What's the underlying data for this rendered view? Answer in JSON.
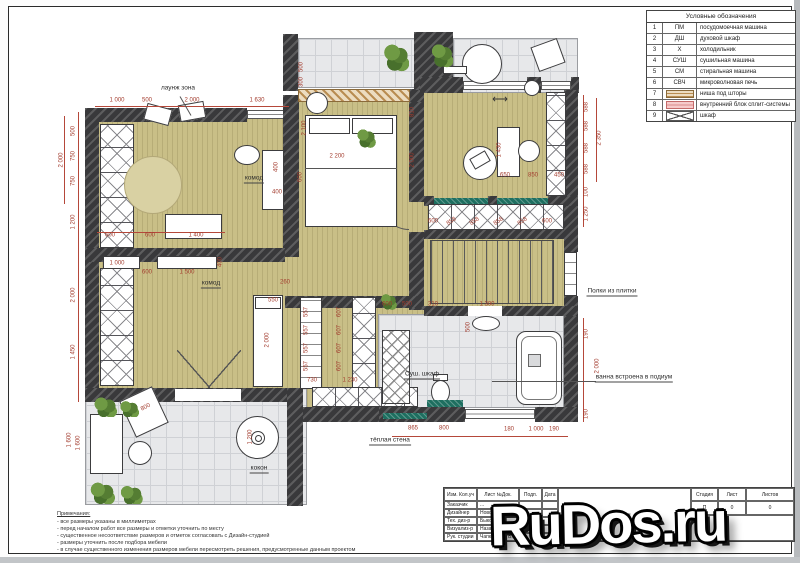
{
  "watermark": {
    "text": "RuDos.ru"
  },
  "colors": {
    "dim_accent": "#b5483a",
    "wall": "#39393b",
    "floor": "#c9bf87",
    "tile": "#e7e8ea",
    "warm_wall_teal": "#1e6f60",
    "legend_pink": "#f6caca"
  },
  "legend": {
    "title": "Условные обозначения",
    "rows": [
      {
        "n": "1",
        "type": "code",
        "code": "ПМ",
        "desc": "посудомоечная машина"
      },
      {
        "n": "2",
        "type": "code",
        "code": "ДШ",
        "desc": "духовой шкаф"
      },
      {
        "n": "3",
        "type": "code",
        "code": "Х",
        "desc": "холодильник"
      },
      {
        "n": "4",
        "type": "code",
        "code": "СУШ",
        "desc": "сушильная машина"
      },
      {
        "n": "5",
        "type": "code",
        "code": "СМ",
        "desc": "стиральная машина"
      },
      {
        "n": "6",
        "type": "code",
        "code": "СВЧ",
        "desc": "микроволновая печь"
      },
      {
        "n": "7",
        "type": "stripes",
        "code": "",
        "desc": "ниша под шторы"
      },
      {
        "n": "8",
        "type": "pink",
        "code": "",
        "desc": "внутренний блок сплит-системы"
      },
      {
        "n": "9",
        "type": "x",
        "code": "",
        "desc": "шкаф"
      }
    ]
  },
  "title_block": {
    "columns": [
      "Изм. Кол.уч",
      "Лист №Док.",
      "Подп.",
      "Дата"
    ],
    "rows": [
      {
        "role": "Заказчик",
        "name": "..."
      },
      {
        "role": "Дизайнер",
        "name": "Новожён А."
      },
      {
        "role": "Тех. диз-р",
        "name": "Быкова А."
      },
      {
        "role": "Визуализ-р",
        "name": "Назарова А."
      },
      {
        "role": "Рук. студии",
        "name": "Чапковский Б."
      }
    ],
    "title": "План",
    "stage_columns": [
      "Стадия",
      "Лист",
      "Листов"
    ],
    "stage_values": [
      "П",
      "0",
      "0"
    ]
  },
  "notes": {
    "title": "Примечания:",
    "lines": [
      "- все размеры указаны в миллиметрах",
      "- перед началом работ все размеры и отметки уточнить по месту",
      "- существенное несоответствие размеров и отметок согласовать с Дизайн-студией",
      "- размеры уточнить после подбора мебели",
      "- в случае существенного изменения размеров мебели пересмотреть решения, предусмотренные данным проектом"
    ]
  },
  "plan": {
    "labels": [
      {
        "t": "лаунж зона",
        "x": 178,
        "y": 88
      },
      {
        "t": "комод",
        "x": 254,
        "y": 179,
        "u": 1
      },
      {
        "t": "комод",
        "x": 211,
        "y": 284,
        "u": 1
      },
      {
        "t": "кокон",
        "x": 259,
        "y": 469,
        "u": 1
      },
      {
        "t": "Суш. шкаф",
        "x": 422,
        "y": 375,
        "u": 1
      },
      {
        "t": "тёплая стена",
        "x": 390,
        "y": 441,
        "u": 1
      },
      {
        "t": "ванна встроена в подиум",
        "x": 634,
        "y": 378,
        "u": 1
      },
      {
        "t": "Полки из плитки",
        "x": 612,
        "y": 292,
        "u": 1
      },
      {
        "t": "⟷",
        "x": 500,
        "y": 100,
        "cls": "arrow"
      }
    ],
    "dimensions": [
      {
        "t": "1 000",
        "x": 117,
        "y": 101
      },
      {
        "t": "500",
        "x": 147,
        "y": 101
      },
      {
        "t": "2 000",
        "x": 192,
        "y": 101
      },
      {
        "t": "1 630",
        "x": 257,
        "y": 101
      },
      {
        "t": "2 000",
        "x": 62,
        "y": 160,
        "r": -90
      },
      {
        "t": "500",
        "x": 74,
        "y": 131,
        "r": -90
      },
      {
        "t": "750",
        "x": 74,
        "y": 156,
        "r": -90
      },
      {
        "t": "750",
        "x": 74,
        "y": 181,
        "r": -90
      },
      {
        "t": "1 200",
        "x": 74,
        "y": 222,
        "r": -90
      },
      {
        "t": "2 000",
        "x": 74,
        "y": 295,
        "r": -90
      },
      {
        "t": "1 450",
        "x": 74,
        "y": 352,
        "r": -90
      },
      {
        "t": "1 600",
        "x": 70,
        "y": 440,
        "r": -90
      },
      {
        "t": "588",
        "x": 587,
        "y": 107,
        "r": -90
      },
      {
        "t": "588",
        "x": 587,
        "y": 126,
        "r": -90
      },
      {
        "t": "588",
        "x": 587,
        "y": 148,
        "r": -90
      },
      {
        "t": "588",
        "x": 587,
        "y": 169,
        "r": -90
      },
      {
        "t": "2 350",
        "x": 600,
        "y": 138,
        "r": -90
      },
      {
        "t": "100",
        "x": 587,
        "y": 192,
        "r": -90
      },
      {
        "t": "1 250",
        "x": 587,
        "y": 214,
        "r": -90
      },
      {
        "t": "190",
        "x": 587,
        "y": 334,
        "r": -90
      },
      {
        "t": "2 000",
        "x": 598,
        "y": 366,
        "r": -90
      },
      {
        "t": "190",
        "x": 587,
        "y": 414,
        "r": -90
      },
      {
        "t": "865",
        "x": 413,
        "y": 429
      },
      {
        "t": "800",
        "x": 444,
        "y": 429
      },
      {
        "t": "180",
        "x": 509,
        "y": 430
      },
      {
        "t": "1 000",
        "x": 536,
        "y": 430
      },
      {
        "t": "190",
        "x": 554,
        "y": 430
      },
      {
        "t": "2 200",
        "x": 337,
        "y": 157
      },
      {
        "t": "500",
        "x": 302,
        "y": 67,
        "r": -90
      },
      {
        "t": "300",
        "x": 302,
        "y": 82,
        "r": -90
      },
      {
        "t": "2 100",
        "x": 305,
        "y": 128,
        "r": -90
      },
      {
        "t": "600",
        "x": 301,
        "y": 177,
        "r": -90
      },
      {
        "t": "810",
        "x": 413,
        "y": 112,
        "r": -90
      },
      {
        "t": "2 000",
        "x": 413,
        "y": 160,
        "r": -90
      },
      {
        "t": "600",
        "x": 110,
        "y": 236
      },
      {
        "t": "600",
        "x": 150,
        "y": 236
      },
      {
        "t": "1 400",
        "x": 196,
        "y": 236
      },
      {
        "t": "400",
        "x": 277,
        "y": 167,
        "r": -90
      },
      {
        "t": "400",
        "x": 277,
        "y": 193
      },
      {
        "t": "1 000",
        "x": 117,
        "y": 264
      },
      {
        "t": "600",
        "x": 147,
        "y": 273
      },
      {
        "t": "1 500",
        "x": 187,
        "y": 273
      },
      {
        "t": "400",
        "x": 221,
        "y": 262,
        "r": -90
      },
      {
        "t": "260",
        "x": 285,
        "y": 283
      },
      {
        "t": "550",
        "x": 273,
        "y": 301
      },
      {
        "t": "2 000",
        "x": 268,
        "y": 340,
        "r": -90
      },
      {
        "t": "557",
        "x": 307,
        "y": 312,
        "r": -90
      },
      {
        "t": "557",
        "x": 307,
        "y": 330,
        "r": -90
      },
      {
        "t": "557",
        "x": 307,
        "y": 348,
        "r": -90
      },
      {
        "t": "557",
        "x": 307,
        "y": 366,
        "r": -90
      },
      {
        "t": "607",
        "x": 340,
        "y": 312,
        "r": -90
      },
      {
        "t": "607",
        "x": 340,
        "y": 330,
        "r": -90
      },
      {
        "t": "607",
        "x": 340,
        "y": 348,
        "r": -90
      },
      {
        "t": "607",
        "x": 340,
        "y": 366,
        "r": -90
      },
      {
        "t": "730",
        "x": 312,
        "y": 381
      },
      {
        "t": "1 230",
        "x": 350,
        "y": 381
      },
      {
        "t": "600",
        "x": 387,
        "y": 305
      },
      {
        "t": "500",
        "x": 407,
        "y": 305
      },
      {
        "t": "310",
        "x": 433,
        "y": 305
      },
      {
        "t": "1 300",
        "x": 487,
        "y": 305
      },
      {
        "t": "500",
        "x": 469,
        "y": 327,
        "r": -90
      },
      {
        "t": "1 430",
        "x": 500,
        "y": 150,
        "r": -90
      },
      {
        "t": "650",
        "x": 505,
        "y": 176
      },
      {
        "t": "850",
        "x": 533,
        "y": 176
      },
      {
        "t": "450",
        "x": 559,
        "y": 176
      },
      {
        "t": "600",
        "x": 433,
        "y": 222
      },
      {
        "t": "858",
        "x": 452,
        "y": 222,
        "r": -35
      },
      {
        "t": "858",
        "x": 475,
        "y": 222,
        "r": -35
      },
      {
        "t": "858",
        "x": 499,
        "y": 222,
        "r": -35
      },
      {
        "t": "858",
        "x": 523,
        "y": 222,
        "r": -35
      },
      {
        "t": "600",
        "x": 547,
        "y": 222
      },
      {
        "t": "1 200",
        "x": 251,
        "y": 437,
        "r": -90
      },
      {
        "t": "800",
        "x": 146,
        "y": 408,
        "r": -28
      },
      {
        "t": "1 600",
        "x": 79,
        "y": 443,
        "r": -90
      }
    ]
  }
}
